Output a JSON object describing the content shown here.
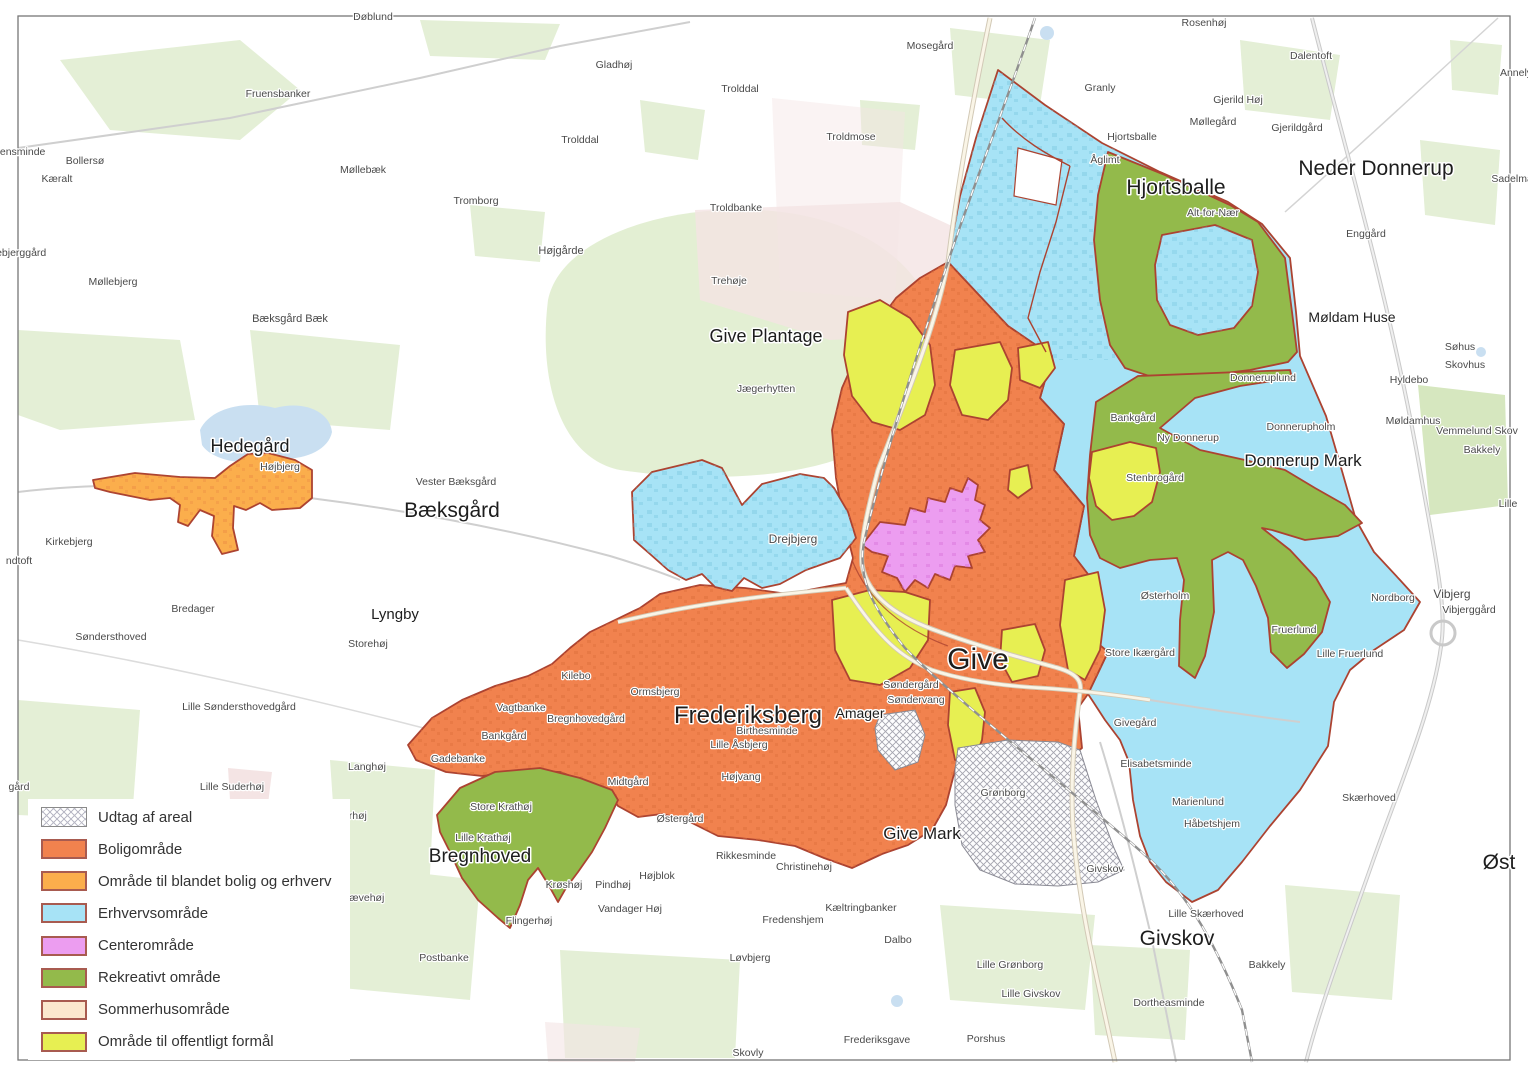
{
  "colors": {
    "bolig": "#F1824E",
    "blandet": "#FBAE4C",
    "erhverv": "#A7E3F6",
    "center": "#EC9DF0",
    "rekreativ": "#93BA4B",
    "sommerhus": "#FBE8CE",
    "offentlig": "#E7EF52",
    "boundary": "#AC4331",
    "hatch_line": "#A4A4AF",
    "water": "#C9DFF1",
    "field": "#E4EFD6",
    "field_dark": "#D6E7BF",
    "pink": "#F4E4E4",
    "road": "#FAF5E7",
    "road_casing": "#D2C9B6",
    "road_gray": "#CFCFCF",
    "railway": "#8F8F8F",
    "label": "#4A4A4A",
    "label_major": "#1D1D1D",
    "frame": "#777777",
    "bg": "#FFFFFF"
  },
  "legend": {
    "items": [
      {
        "key": "udtag",
        "label": "Udtag af areal"
      },
      {
        "key": "bolig",
        "label": "Boligområde"
      },
      {
        "key": "blandet",
        "label": "Område til blandet bolig og erhverv"
      },
      {
        "key": "erhverv",
        "label": "Erhvervsområde"
      },
      {
        "key": "center",
        "label": "Centerområde"
      },
      {
        "key": "rekreativ",
        "label": "Rekreativt område"
      },
      {
        "key": "sommerhus",
        "label": "Sommerhusområde"
      },
      {
        "key": "offentlig",
        "label": "Område til offentligt formål"
      }
    ]
  },
  "map_labels": [
    {
      "t": "Give",
      "x": 978,
      "y": 669,
      "s": 30,
      "k": "major"
    },
    {
      "t": "Frederiksberg",
      "x": 748,
      "y": 723,
      "s": 24,
      "k": "major"
    },
    {
      "t": "Hjortsballe",
      "x": 1176,
      "y": 194,
      "s": 21,
      "k": "major"
    },
    {
      "t": "Neder Donnerup",
      "x": 1376,
      "y": 175,
      "s": 21,
      "k": "major"
    },
    {
      "t": "Bæksgård",
      "x": 452,
      "y": 517,
      "s": 21,
      "k": "major"
    },
    {
      "t": "Givskov",
      "x": 1177,
      "y": 945,
      "s": 21,
      "k": "major"
    },
    {
      "t": "Bregnhoved",
      "x": 480,
      "y": 862,
      "s": 19,
      "k": "major"
    },
    {
      "t": "Hedegård",
      "x": 250,
      "y": 452,
      "s": 18,
      "k": "major"
    },
    {
      "t": "Give Plantage",
      "x": 766,
      "y": 342,
      "s": 18,
      "k": "major"
    },
    {
      "t": "Donnerup Mark",
      "x": 1303,
      "y": 466,
      "s": 17,
      "k": "major"
    },
    {
      "t": "Give Mark",
      "x": 922,
      "y": 839,
      "s": 17,
      "k": "major"
    },
    {
      "t": "Lyngby",
      "x": 395,
      "y": 619,
      "s": 15,
      "k": "major"
    },
    {
      "t": "Møldam Huse",
      "x": 1352,
      "y": 322,
      "s": 14,
      "k": "major"
    },
    {
      "t": "Amager",
      "x": 860,
      "y": 718,
      "s": 14,
      "k": "major"
    },
    {
      "t": "Øst",
      "x": 1499,
      "y": 869,
      "s": 21,
      "k": "major"
    },
    {
      "t": "Vibjerg",
      "x": 1452,
      "y": 598,
      "s": 12
    },
    {
      "t": "Drejbjerg",
      "x": 793,
      "y": 543,
      "s": 12
    },
    {
      "t": "Døblund",
      "x": 373,
      "y": 20,
      "s": 10.5
    },
    {
      "t": "Fruensbanker",
      "x": 278,
      "y": 97,
      "s": 10.5
    },
    {
      "t": "kensminde",
      "x": 20,
      "y": 155,
      "s": 10.5,
      "a": "start"
    },
    {
      "t": "Bollersø",
      "x": 85,
      "y": 164,
      "s": 10.5
    },
    {
      "t": "Kæralt",
      "x": 57,
      "y": 182,
      "s": 10.5
    },
    {
      "t": "Møllebæk",
      "x": 363,
      "y": 173,
      "s": 10.5
    },
    {
      "t": "Tromborg",
      "x": 476,
      "y": 204,
      "s": 10.5
    },
    {
      "t": "lebjerggård",
      "x": 20,
      "y": 256,
      "s": 10.5,
      "a": "start"
    },
    {
      "t": "Møllebjerg",
      "x": 113,
      "y": 285,
      "s": 10.5
    },
    {
      "t": "Bæksgård Bæk",
      "x": 290,
      "y": 322,
      "s": 11
    },
    {
      "t": "Højgårde",
      "x": 561,
      "y": 254,
      "s": 11
    },
    {
      "t": "Gladhøj",
      "x": 614,
      "y": 68,
      "s": 10.5
    },
    {
      "t": "Trolddal",
      "x": 740,
      "y": 92,
      "s": 10.5
    },
    {
      "t": "Trolddal",
      "x": 580,
      "y": 143,
      "s": 10.5
    },
    {
      "t": "Troldmose",
      "x": 851,
      "y": 140,
      "s": 10.5
    },
    {
      "t": "Troldbanke",
      "x": 736,
      "y": 211,
      "s": 10.5
    },
    {
      "t": "Trehøje",
      "x": 729,
      "y": 284,
      "s": 10.5
    },
    {
      "t": "Jægerhytten",
      "x": 766,
      "y": 392,
      "s": 10.5
    },
    {
      "t": "Mosegård",
      "x": 930,
      "y": 49,
      "s": 10.5
    },
    {
      "t": "Rosenhøj",
      "x": 1204,
      "y": 26,
      "s": 10.5
    },
    {
      "t": "Granly",
      "x": 1100,
      "y": 91,
      "s": 10.5
    },
    {
      "t": "Hjortsballe",
      "x": 1132,
      "y": 140,
      "s": 10.5
    },
    {
      "t": "Åglimt",
      "x": 1105,
      "y": 163,
      "s": 10.5
    },
    {
      "t": "Gjerild Høj",
      "x": 1238,
      "y": 103,
      "s": 10.5
    },
    {
      "t": "Møllegård",
      "x": 1213,
      "y": 125,
      "s": 10.5
    },
    {
      "t": "Gjerildgård",
      "x": 1297,
      "y": 131,
      "s": 10.5
    },
    {
      "t": "Dalentoft",
      "x": 1311,
      "y": 59,
      "s": 10.5
    },
    {
      "t": "Annely",
      "x": 1516,
      "y": 76,
      "s": 10.5
    },
    {
      "t": "Alt-for-Nær",
      "x": 1213,
      "y": 216,
      "s": 10.5
    },
    {
      "t": "Enggård",
      "x": 1366,
      "y": 237,
      "s": 10.5
    },
    {
      "t": "Sadelmag",
      "x": 1515,
      "y": 182,
      "s": 10.5
    },
    {
      "t": "Møldamhus",
      "x": 1413,
      "y": 424,
      "s": 10.5
    },
    {
      "t": "Vemmelund Skov",
      "x": 1477,
      "y": 434,
      "s": 10.5
    },
    {
      "t": "Søhus",
      "x": 1460,
      "y": 350,
      "s": 10.5
    },
    {
      "t": "Skovhus",
      "x": 1465,
      "y": 368,
      "s": 10.5
    },
    {
      "t": "Hyldebo",
      "x": 1409,
      "y": 383,
      "s": 10.5
    },
    {
      "t": "Bakkely",
      "x": 1482,
      "y": 453,
      "s": 10.5
    },
    {
      "t": "Lille",
      "x": 1508,
      "y": 507,
      "s": 10.5
    },
    {
      "t": "Donneruplund",
      "x": 1263,
      "y": 381,
      "s": 10.5
    },
    {
      "t": "Donnerupholm",
      "x": 1301,
      "y": 430,
      "s": 10.5
    },
    {
      "t": "Ny Donnerup",
      "x": 1188,
      "y": 441,
      "s": 10.5
    },
    {
      "t": "Stenbrogård",
      "x": 1155,
      "y": 481,
      "s": 10.5
    },
    {
      "t": "Bankgård",
      "x": 1133,
      "y": 421,
      "s": 10.5
    },
    {
      "t": "Østerholm",
      "x": 1165,
      "y": 599,
      "s": 10.5
    },
    {
      "t": "Store Ikærgård",
      "x": 1140,
      "y": 656,
      "s": 10.5
    },
    {
      "t": "Fruerlund",
      "x": 1294,
      "y": 633,
      "s": 10.5
    },
    {
      "t": "Lille Fruerlund",
      "x": 1350,
      "y": 657,
      "s": 10.5
    },
    {
      "t": "Nordborg",
      "x": 1393,
      "y": 601,
      "s": 10.5
    },
    {
      "t": "Vibjerggård",
      "x": 1469,
      "y": 613,
      "s": 10.5
    },
    {
      "t": "Givegård",
      "x": 1135,
      "y": 726,
      "s": 10.5
    },
    {
      "t": "Elisabetsminde",
      "x": 1156,
      "y": 767,
      "s": 10.5
    },
    {
      "t": "Marienlund",
      "x": 1198,
      "y": 805,
      "s": 10.5
    },
    {
      "t": "Håbetshjem",
      "x": 1212,
      "y": 827,
      "s": 10.5
    },
    {
      "t": "Lille Skærhoved",
      "x": 1206,
      "y": 917,
      "s": 10.5
    },
    {
      "t": "Givskov",
      "x": 1105,
      "y": 872,
      "s": 10.5
    },
    {
      "t": "Skærhoved",
      "x": 1369,
      "y": 801,
      "s": 10.5
    },
    {
      "t": "Dalbo",
      "x": 898,
      "y": 943,
      "s": 10.5
    },
    {
      "t": "Lille Grønborg",
      "x": 1010,
      "y": 968,
      "s": 10.5
    },
    {
      "t": "Lille Givskov",
      "x": 1031,
      "y": 997,
      "s": 10.5
    },
    {
      "t": "Dortheasminde",
      "x": 1169,
      "y": 1006,
      "s": 10.5
    },
    {
      "t": "Bakkely",
      "x": 1267,
      "y": 968,
      "s": 10.5
    },
    {
      "t": "Porshus",
      "x": 986,
      "y": 1042,
      "s": 10.5
    },
    {
      "t": "Frederiksgave",
      "x": 877,
      "y": 1043,
      "s": 10.5
    },
    {
      "t": "Skovly",
      "x": 748,
      "y": 1056,
      "s": 10.5
    },
    {
      "t": "Løvbjerg",
      "x": 750,
      "y": 961,
      "s": 10.5
    },
    {
      "t": "Fredenshjem",
      "x": 793,
      "y": 923,
      "s": 10.5
    },
    {
      "t": "Kæltringbanker",
      "x": 861,
      "y": 911,
      "s": 10.5
    },
    {
      "t": "Christinehøj",
      "x": 804,
      "y": 870,
      "s": 10.5
    },
    {
      "t": "Rikkesminde",
      "x": 746,
      "y": 859,
      "s": 10.5
    },
    {
      "t": "Højblok",
      "x": 657,
      "y": 879,
      "s": 10.5
    },
    {
      "t": "Pindhøj",
      "x": 613,
      "y": 888,
      "s": 10.5
    },
    {
      "t": "Vandager Høj",
      "x": 630,
      "y": 912,
      "s": 10.5
    },
    {
      "t": "Flingerhøj",
      "x": 529,
      "y": 924,
      "s": 10.5
    },
    {
      "t": "Krøshøj",
      "x": 564,
      "y": 888,
      "s": 10.5
    },
    {
      "t": "Postbanke",
      "x": 444,
      "y": 961,
      "s": 10.5
    },
    {
      "t": "Store Krathøj",
      "x": 501,
      "y": 810,
      "s": 10.5
    },
    {
      "t": "Lille Krathøj",
      "x": 483,
      "y": 841,
      "s": 10.5
    },
    {
      "t": "Rævehøj",
      "x": 363,
      "y": 901,
      "s": 10.5
    },
    {
      "t": "derhøj",
      "x": 352,
      "y": 819,
      "s": 10.5
    },
    {
      "t": "Langhøj",
      "x": 367,
      "y": 770,
      "s": 10.5
    },
    {
      "t": "Lille Suderhøj",
      "x": 232,
      "y": 790,
      "s": 10.5
    },
    {
      "t": "Lille Søndersthovedgård",
      "x": 239,
      "y": 710,
      "s": 10.5
    },
    {
      "t": "Søndersthoved",
      "x": 111,
      "y": 640,
      "s": 10.5
    },
    {
      "t": "Bredager",
      "x": 193,
      "y": 612,
      "s": 10.5
    },
    {
      "t": "Kirkebjerg",
      "x": 69,
      "y": 545,
      "s": 10.5
    },
    {
      "t": "ndtoft",
      "x": 19,
      "y": 564,
      "s": 10.5,
      "a": "start"
    },
    {
      "t": "gård",
      "x": 19,
      "y": 790,
      "s": 10.5,
      "a": "start"
    },
    {
      "t": "Storehøj",
      "x": 368,
      "y": 647,
      "s": 10.5
    },
    {
      "t": "Vester Bæksgård",
      "x": 456,
      "y": 485,
      "s": 10.5
    },
    {
      "t": "Højbjerg",
      "x": 280,
      "y": 470,
      "s": 10.5
    },
    {
      "t": "Søndergård",
      "x": 911,
      "y": 688,
      "s": 10.5
    },
    {
      "t": "Søndervang",
      "x": 916,
      "y": 703,
      "s": 10.5
    },
    {
      "t": "Grønborg",
      "x": 1003,
      "y": 796,
      "s": 10.5
    },
    {
      "t": "Ormsbjerg",
      "x": 655,
      "y": 695,
      "s": 10.5
    },
    {
      "t": "Kilebo",
      "x": 576,
      "y": 679,
      "s": 10.5
    },
    {
      "t": "Vagtbanke",
      "x": 521,
      "y": 711,
      "s": 10.5
    },
    {
      "t": "Bregnhovedgård",
      "x": 586,
      "y": 722,
      "s": 10.5
    },
    {
      "t": "Bankgård",
      "x": 504,
      "y": 739,
      "s": 10.5
    },
    {
      "t": "Gadebanke",
      "x": 458,
      "y": 762,
      "s": 10.5
    },
    {
      "t": "Birthesminde",
      "x": 767,
      "y": 734,
      "s": 10.5
    },
    {
      "t": "Lille Åsbjerg",
      "x": 739,
      "y": 748,
      "s": 10.5
    },
    {
      "t": "Højvang",
      "x": 741,
      "y": 780,
      "s": 10.5
    },
    {
      "t": "Midtgård",
      "x": 628,
      "y": 785,
      "s": 10.5
    },
    {
      "t": "Østergård",
      "x": 680,
      "y": 822,
      "s": 10.5
    }
  ]
}
